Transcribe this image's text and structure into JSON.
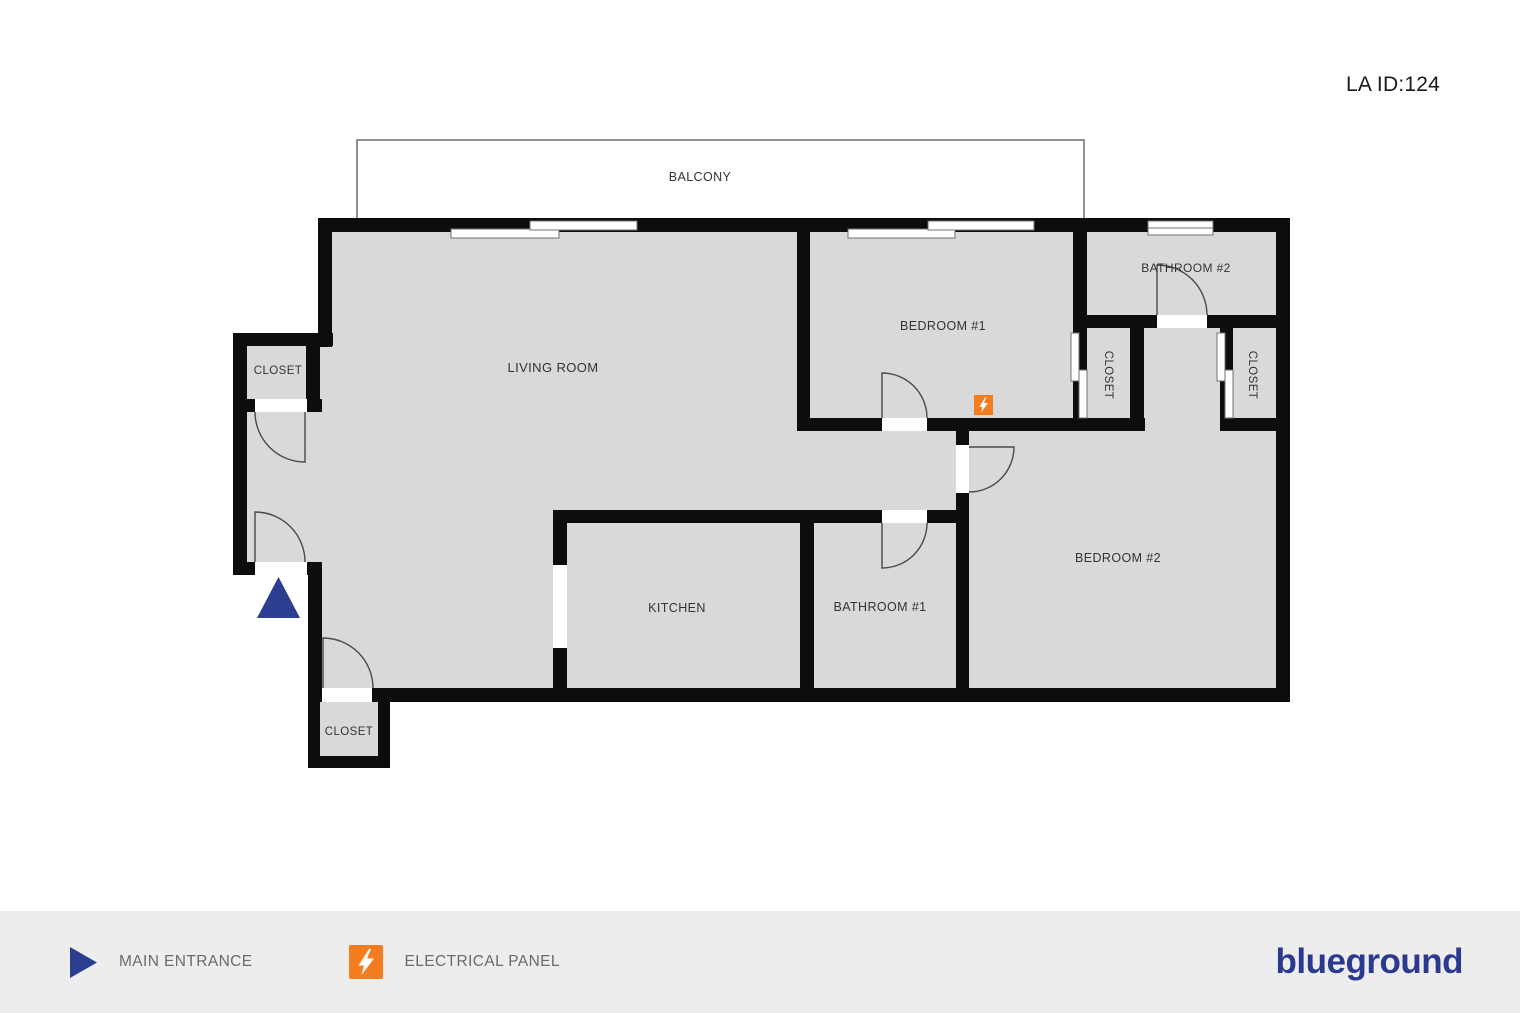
{
  "header": {
    "listing_id": "LA ID:124"
  },
  "plan": {
    "labels": {
      "balcony": "BALCONY",
      "living_room": "LIVING ROOM",
      "bedroom_1": "BEDROOM #1",
      "bedroom_2": "BEDROOM #2",
      "bathroom_1": "BATHROOM #1",
      "bathroom_2": "BATHROOM #2",
      "kitchen": "KITCHEN",
      "closet_entry": "CLOSET",
      "closet_living_room": "CLOSET",
      "closet_bedroom_1": "CLOSET",
      "closet_hall": "CLOSET"
    },
    "markers": {
      "main_entrance": "main entrance",
      "electrical_panel": "electrical panel"
    }
  },
  "legend": {
    "main_entrance_label": "MAIN ENTRANCE",
    "electrical_panel_label": "ELECTRICAL PANEL"
  },
  "brand": {
    "logo_text": "blueground"
  },
  "colors": {
    "brand_navy": "#2B3990",
    "entrance_navy": "#2C3E8F",
    "accent_orange": "#F57D20",
    "wall_black": "#0D0D0D",
    "room_fill": "#D9D9D9",
    "label_text": "#333333",
    "legend_text": "#6B6B6B",
    "footer_bg": "#EDEDED"
  }
}
